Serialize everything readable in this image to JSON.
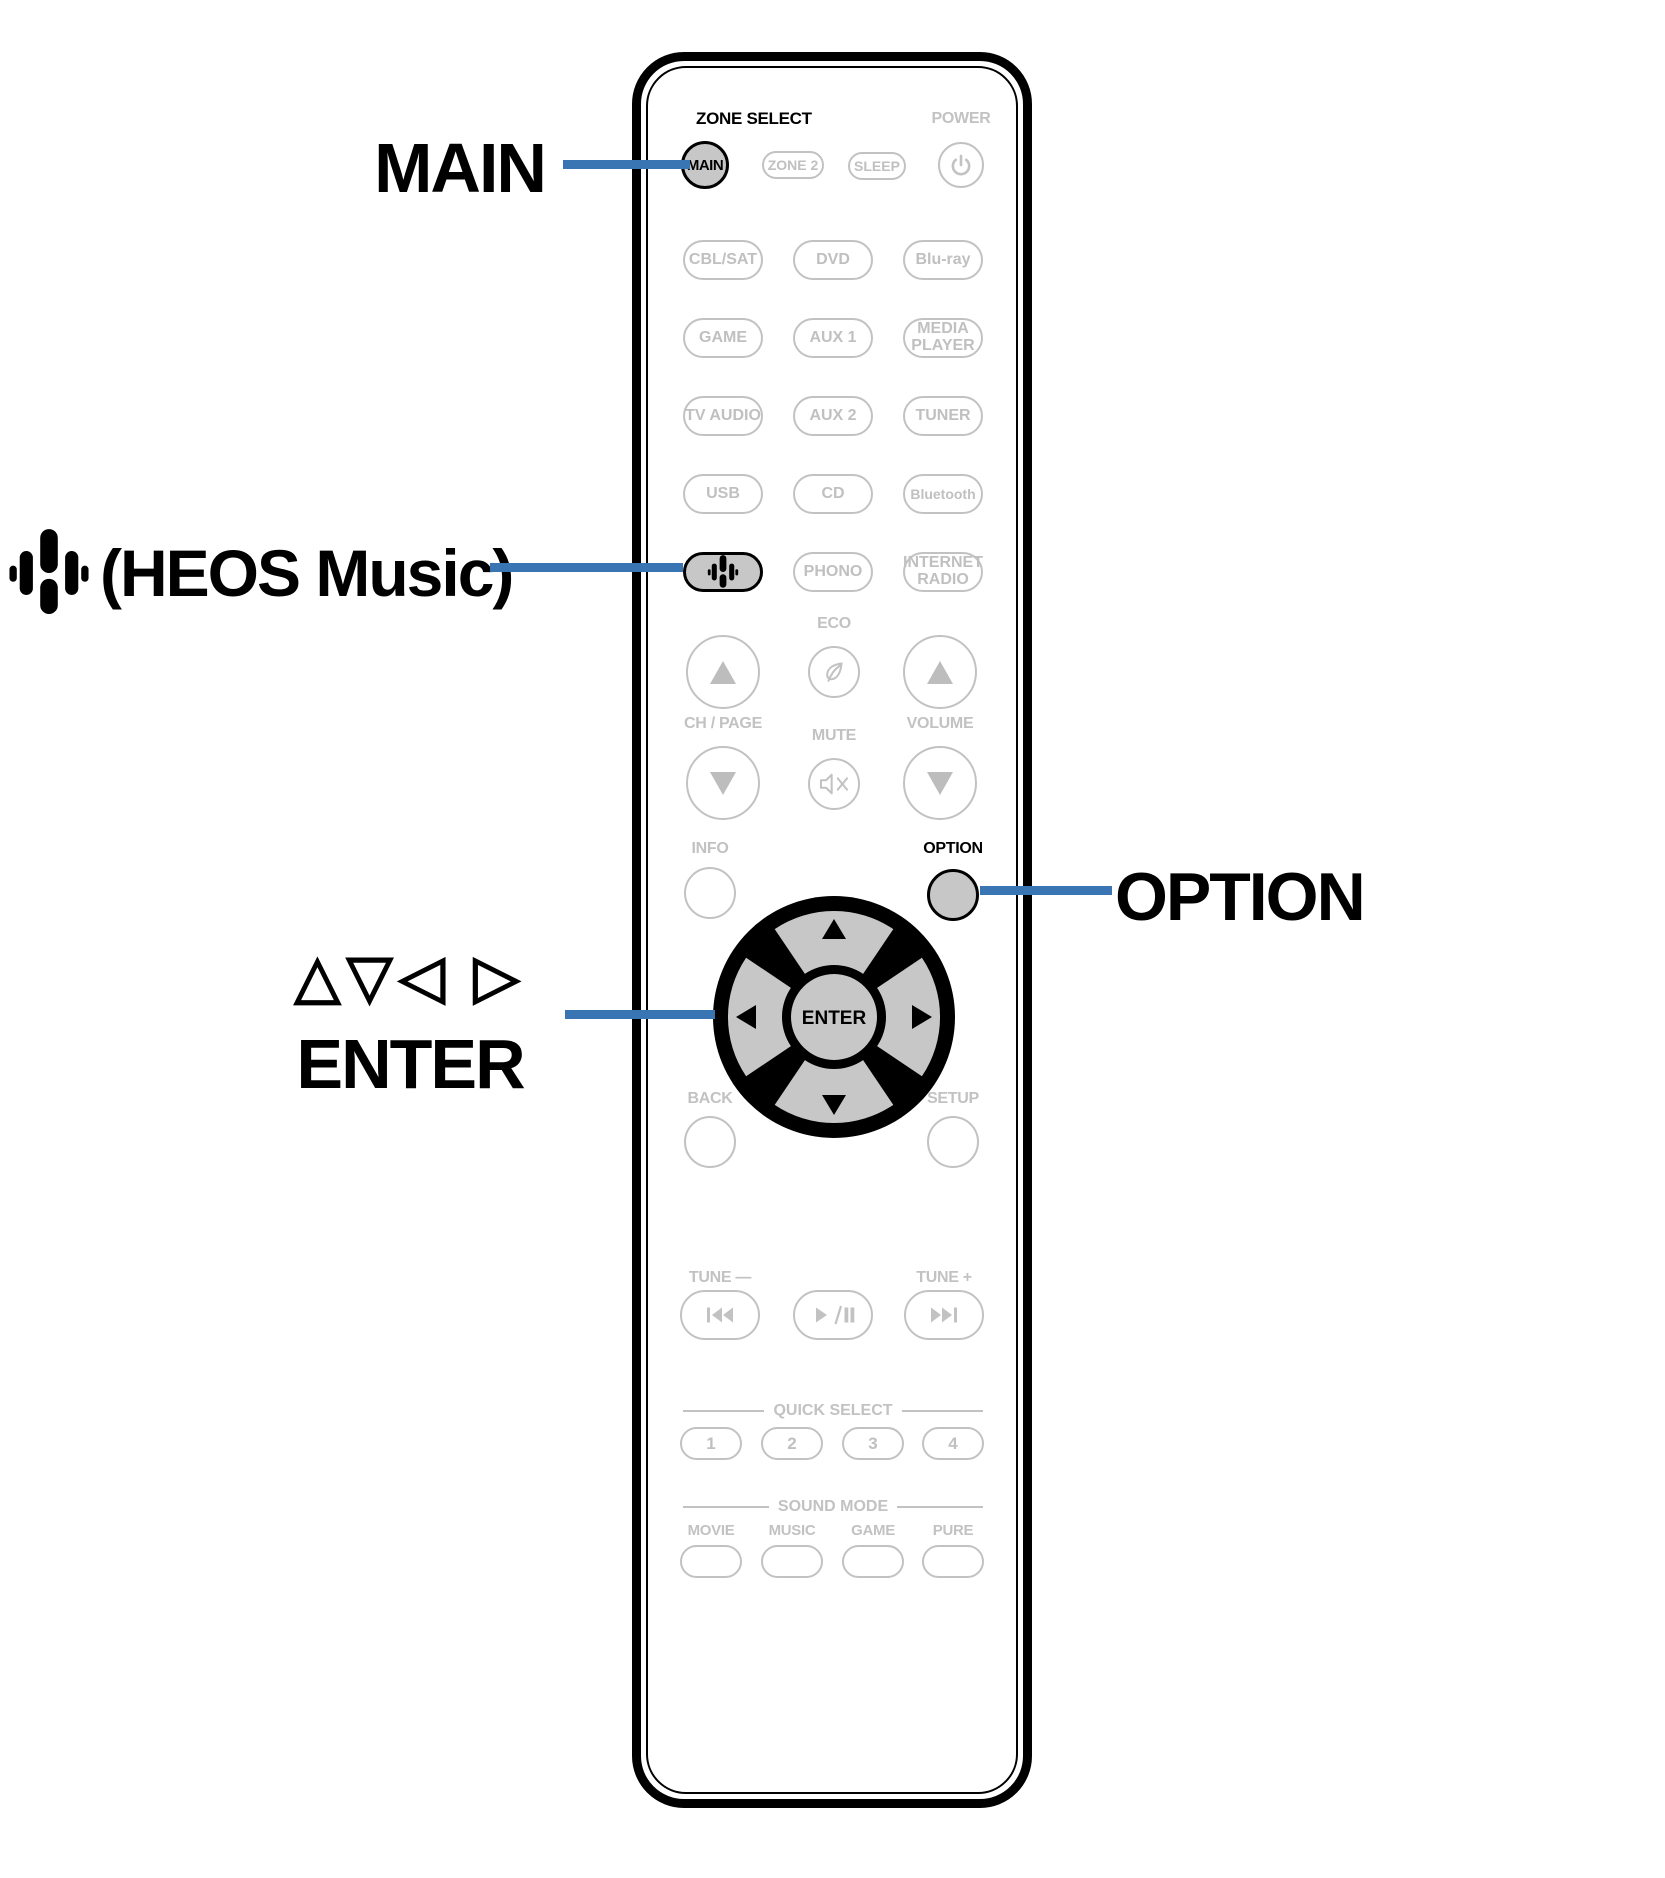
{
  "colors": {
    "accent_blue": "#3875b2",
    "button_gray": "#c7c7c7",
    "inactive_gray": "#c2c2c2"
  },
  "callouts": {
    "main_label": "MAIN",
    "heos_label": "(HEOS Music)",
    "cursor_triangles": "△▽◁ ▷",
    "enter_label": "ENTER",
    "option_label": "OPTION"
  },
  "remote": {
    "zone_select_label": "ZONE SELECT",
    "power_label": "POWER",
    "main_button": "MAIN",
    "zone2_button": "ZONE 2",
    "sleep_button": "SLEEP",
    "sources": [
      "CBL/SAT",
      "DVD",
      "Blu-ray",
      "GAME",
      "AUX 1",
      "MEDIA PLAYER",
      "TV AUDIO",
      "AUX 2",
      "TUNER",
      "USB",
      "CD",
      "Bluetooth",
      "PHONO",
      "INTERNET RADIO"
    ],
    "eco_label": "ECO",
    "ch_page_label": "CH / PAGE",
    "mute_label": "MUTE",
    "volume_label": "VOLUME",
    "info_label": "INFO",
    "option_label": "OPTION",
    "enter_label": "ENTER",
    "back_label": "BACK",
    "setup_label": "SETUP",
    "tune_minus_label": "TUNE —",
    "tune_plus_label": "TUNE +",
    "quick_select_label": "QUICK SELECT",
    "quick_select_buttons": [
      "1",
      "2",
      "3",
      "4"
    ],
    "sound_mode_label": "SOUND MODE",
    "sound_mode_buttons": [
      "MOVIE",
      "MUSIC",
      "GAME",
      "PURE"
    ]
  }
}
